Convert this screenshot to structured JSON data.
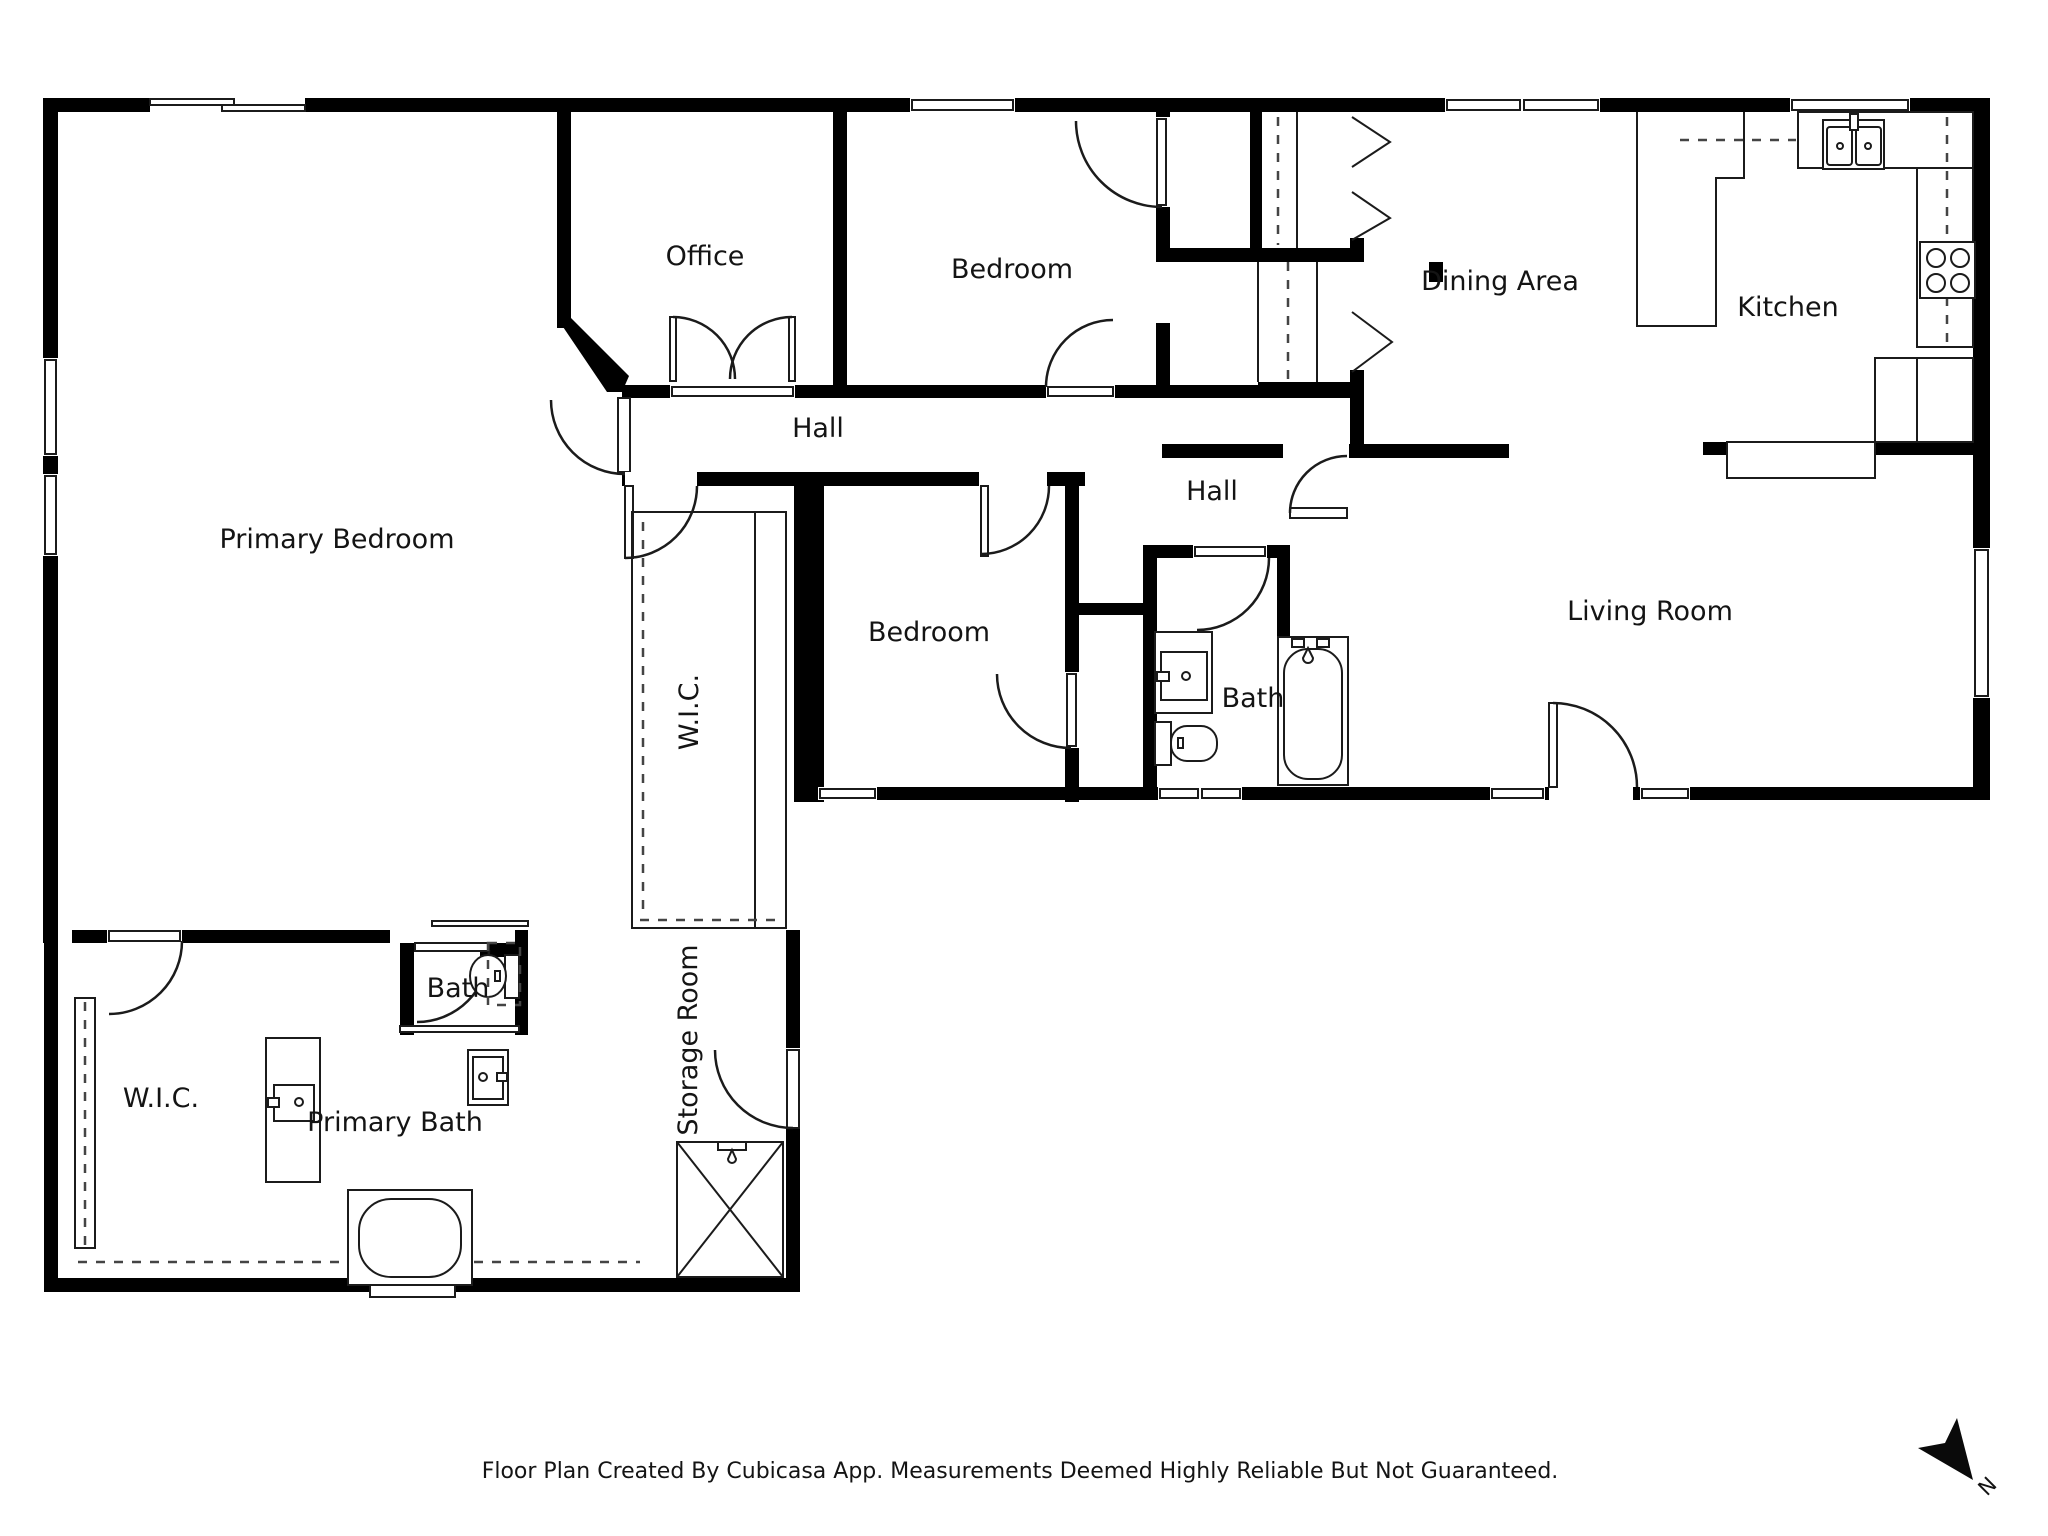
{
  "floor_plan": {
    "rooms": [
      {
        "id": "primary-bedroom",
        "label": "Primary Bedroom"
      },
      {
        "id": "office",
        "label": "Office"
      },
      {
        "id": "bedroom-top",
        "label": "Bedroom"
      },
      {
        "id": "dining-area",
        "label": "Dining Area"
      },
      {
        "id": "kitchen",
        "label": "Kitchen"
      },
      {
        "id": "hall-west",
        "label": "Hall"
      },
      {
        "id": "hall-east",
        "label": "Hall"
      },
      {
        "id": "bedroom-middle",
        "label": "Bedroom"
      },
      {
        "id": "bath-hall",
        "label": "Bath"
      },
      {
        "id": "living-room",
        "label": "Living Room"
      },
      {
        "id": "wic-corridor",
        "label": "W.I.C."
      },
      {
        "id": "bath-primary-nook",
        "label": "Bath"
      },
      {
        "id": "primary-bath",
        "label": "Primary Bath"
      },
      {
        "id": "wic-bottom",
        "label": "W.I.C."
      },
      {
        "id": "storage-room",
        "label": "Storage Room"
      }
    ],
    "footer_text": "Floor Plan Created By Cubicasa App. Measurements Deemed Highly Reliable But Not Guaranteed.",
    "compass": {
      "label": "N"
    },
    "colors": {
      "wall": "#000000",
      "floor": "#ffffff",
      "line": "#1b1b1b"
    }
  }
}
